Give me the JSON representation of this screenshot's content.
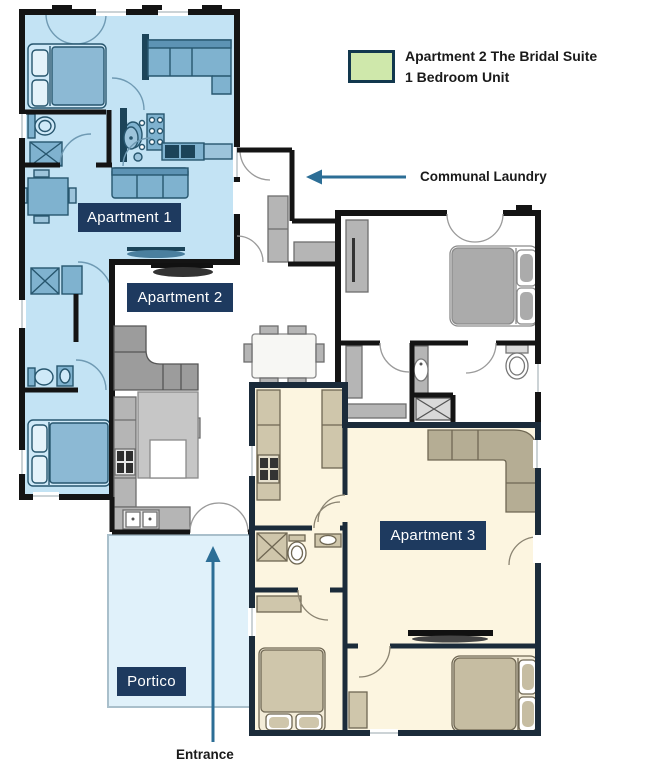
{
  "legend": {
    "line1": "Apartment 2 The Bridal Suite",
    "line2": "1 Bedroom Unit",
    "swatch_color": "#cfe8ab",
    "swatch_border": "#12384e"
  },
  "rooms": {
    "apartment1": "Apartment 1",
    "apartment2": "Apartment 2",
    "apartment3": "Apartment 3",
    "portico": "Portico"
  },
  "annotations": {
    "communal_laundry": "Communal Laundry",
    "entrance": "Entrance"
  },
  "colors": {
    "label_bg": "#1e3a5f",
    "label_text": "#ffffff",
    "arrow": "#2c6e96",
    "wall_dark": "#141414",
    "apt3_wall": "#1b2b3a",
    "apt1_floor": "#c3e3f4",
    "apt1_furniture": "#7fb2cf",
    "apt3_floor": "#fcf5e0",
    "apt3_furniture": "#cfc6ab",
    "portico_floor": "#e0f1fa",
    "unit_furniture_gray": "#b5b5b5",
    "annotation_text": "#1a1a1a"
  }
}
